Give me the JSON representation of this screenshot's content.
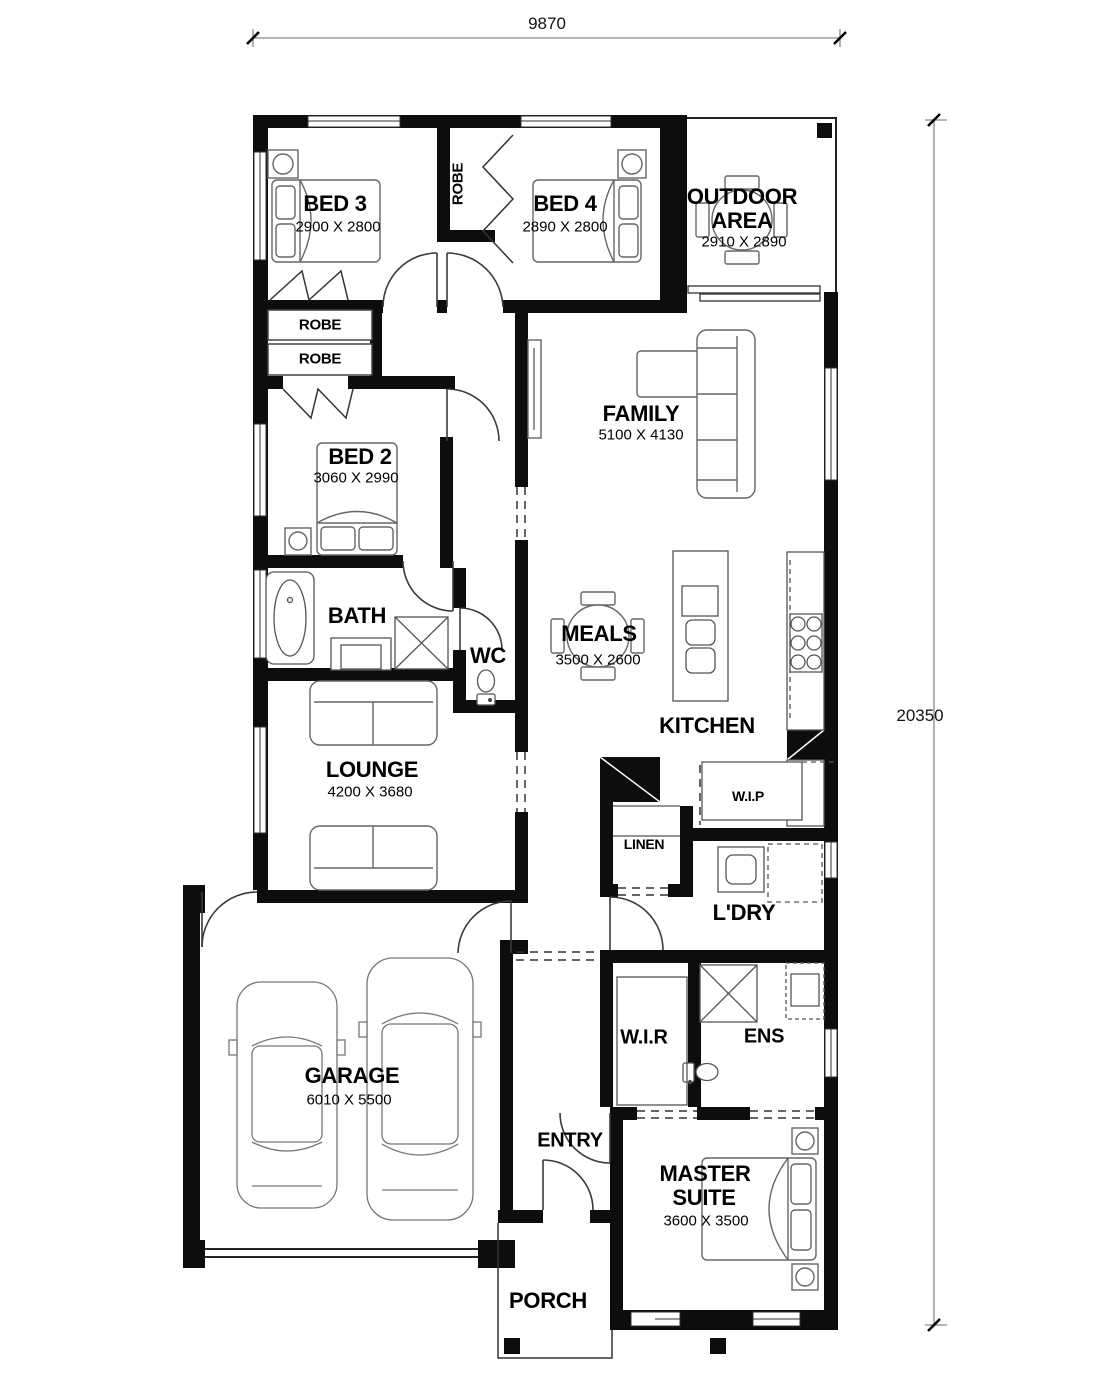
{
  "plan": {
    "dimensions": {
      "width": "9870",
      "height": "20350"
    },
    "rooms": {
      "bed3": {
        "name": "BED 3",
        "size": "2900 X 2800"
      },
      "bed4": {
        "name": "BED 4",
        "size": "2890 X 2800"
      },
      "outdoor": {
        "name_line1": "OUTDOOR",
        "name_line2": "AREA",
        "size": "2910 X 2890"
      },
      "bed2": {
        "name": "BED 2",
        "size": "3060 X 2990"
      },
      "family": {
        "name": "FAMILY",
        "size": "5100 X 4130"
      },
      "bath": {
        "name": "BATH"
      },
      "wc": {
        "name": "WC"
      },
      "meals": {
        "name": "MEALS",
        "size": "3500 X 2600"
      },
      "kitchen": {
        "name": "KITCHEN"
      },
      "wip": {
        "name": "W.I.P"
      },
      "linen": {
        "name": "LINEN"
      },
      "lounge": {
        "name": "LOUNGE",
        "size": "4200 X 3680"
      },
      "ldry": {
        "name": "L'DRY"
      },
      "garage": {
        "name": "GARAGE",
        "size": "6010 X 5500"
      },
      "wir": {
        "name": "W.I.R"
      },
      "ens": {
        "name": "ENS"
      },
      "entry": {
        "name": "ENTRY"
      },
      "master": {
        "name_line1": "MASTER",
        "name_line2": "SUITE",
        "size": "3600 X 3500"
      },
      "porch": {
        "name": "PORCH"
      },
      "robe_bed34": {
        "name": "ROBE"
      },
      "robe_hall_top": {
        "name": "ROBE"
      },
      "robe_hall_bottom": {
        "name": "ROBE"
      }
    },
    "colors": {
      "wall": "#0d0d0d",
      "line": "#333333",
      "furniture": "#666666",
      "dim_line": "#888888"
    }
  }
}
